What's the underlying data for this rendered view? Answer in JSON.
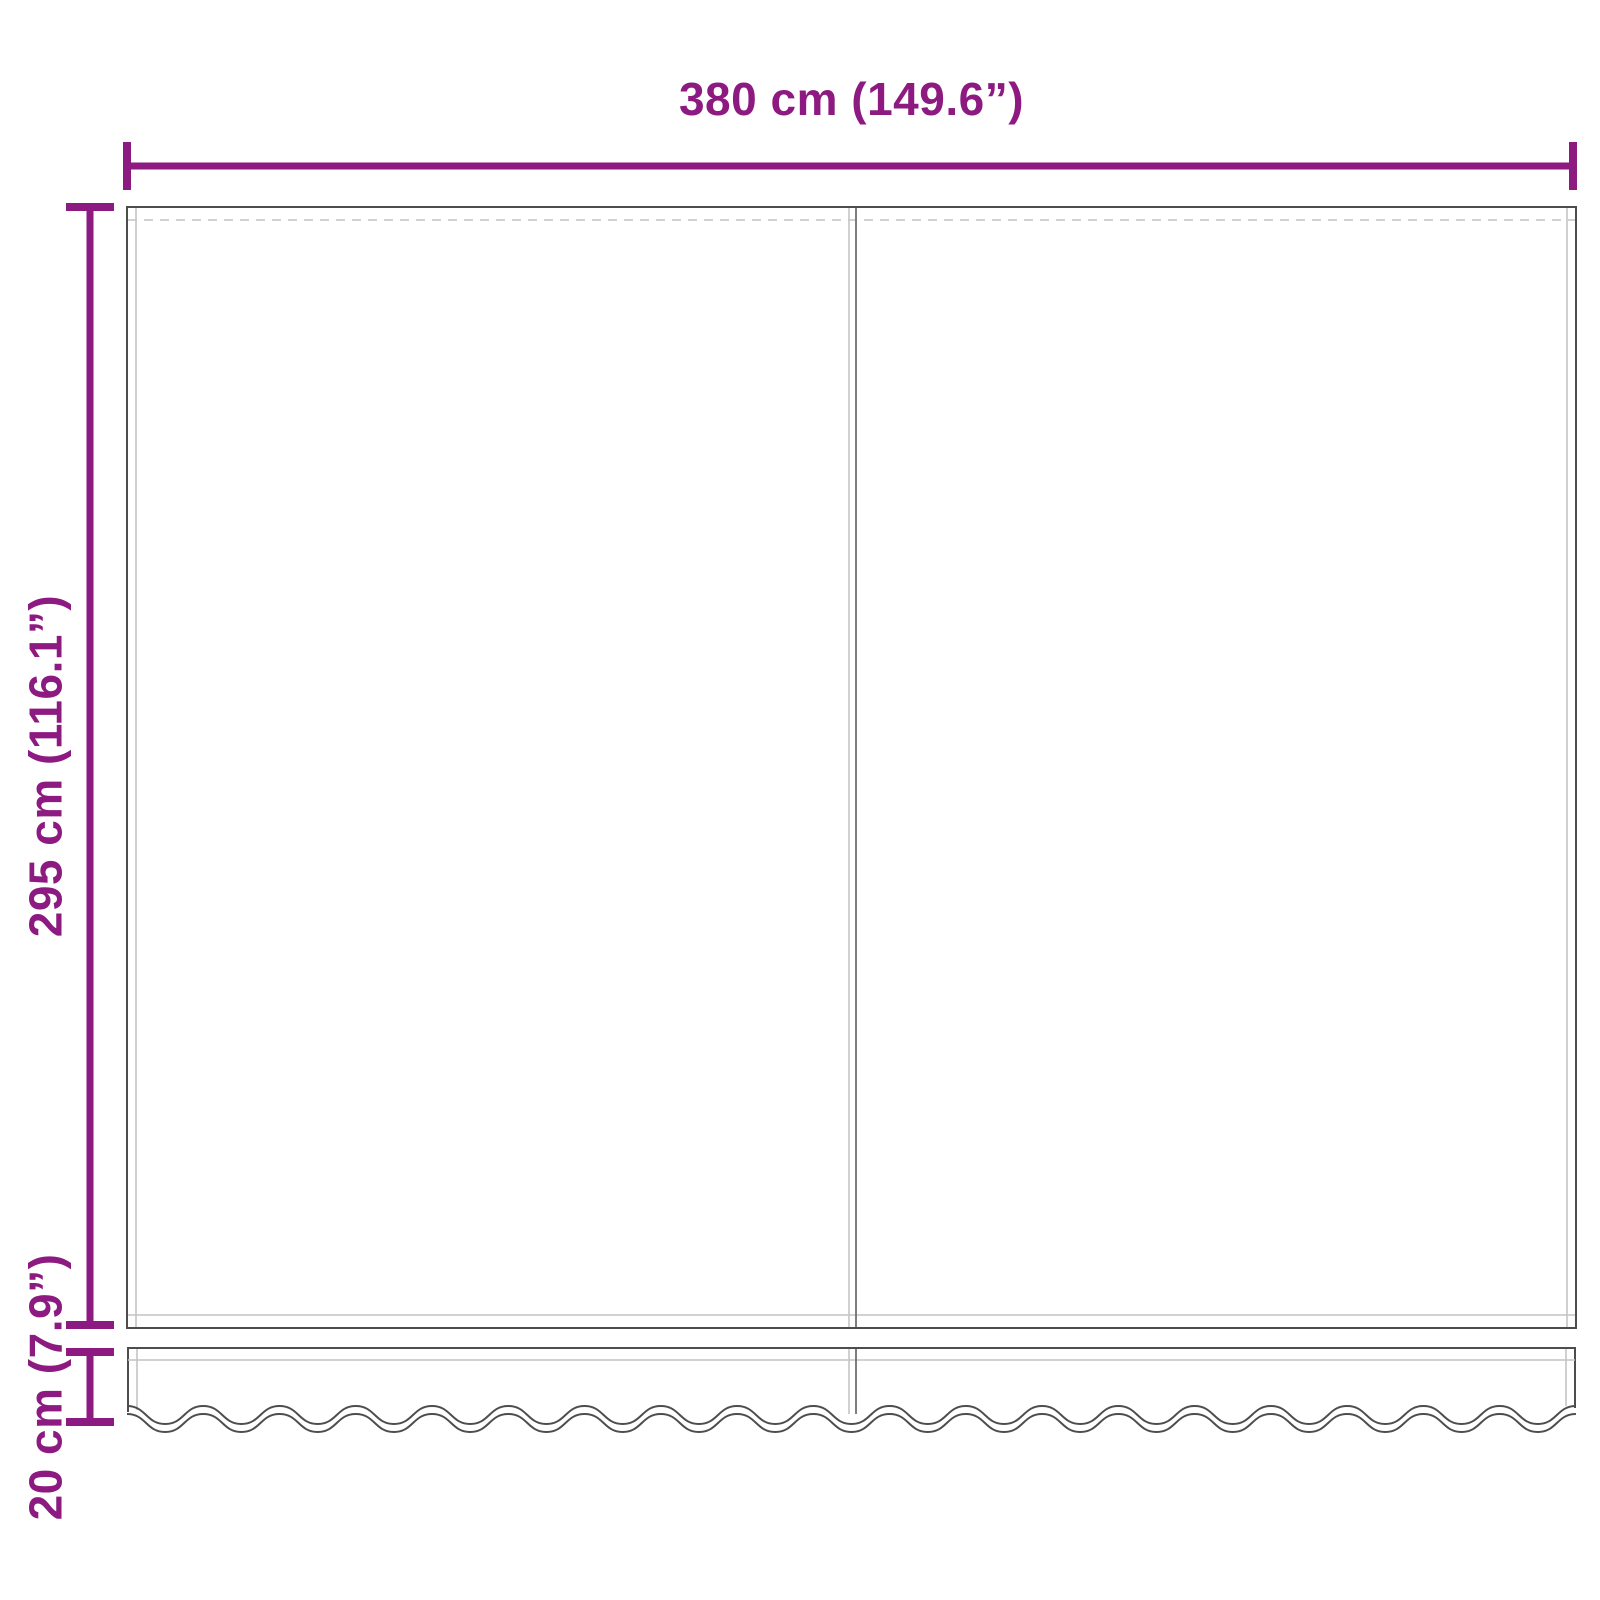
{
  "diagram": {
    "labels": {
      "width": "380 cm (149.6”)",
      "height": "295 cm (116.1”)",
      "valance_height": "20 cm (7.9”)"
    },
    "colors": {
      "accent": "#8C1A80",
      "outline": "#4D4D4D",
      "stitch": "#C4C4C4",
      "seam_dark": "#707070",
      "background": "#FFFFFF"
    }
  }
}
